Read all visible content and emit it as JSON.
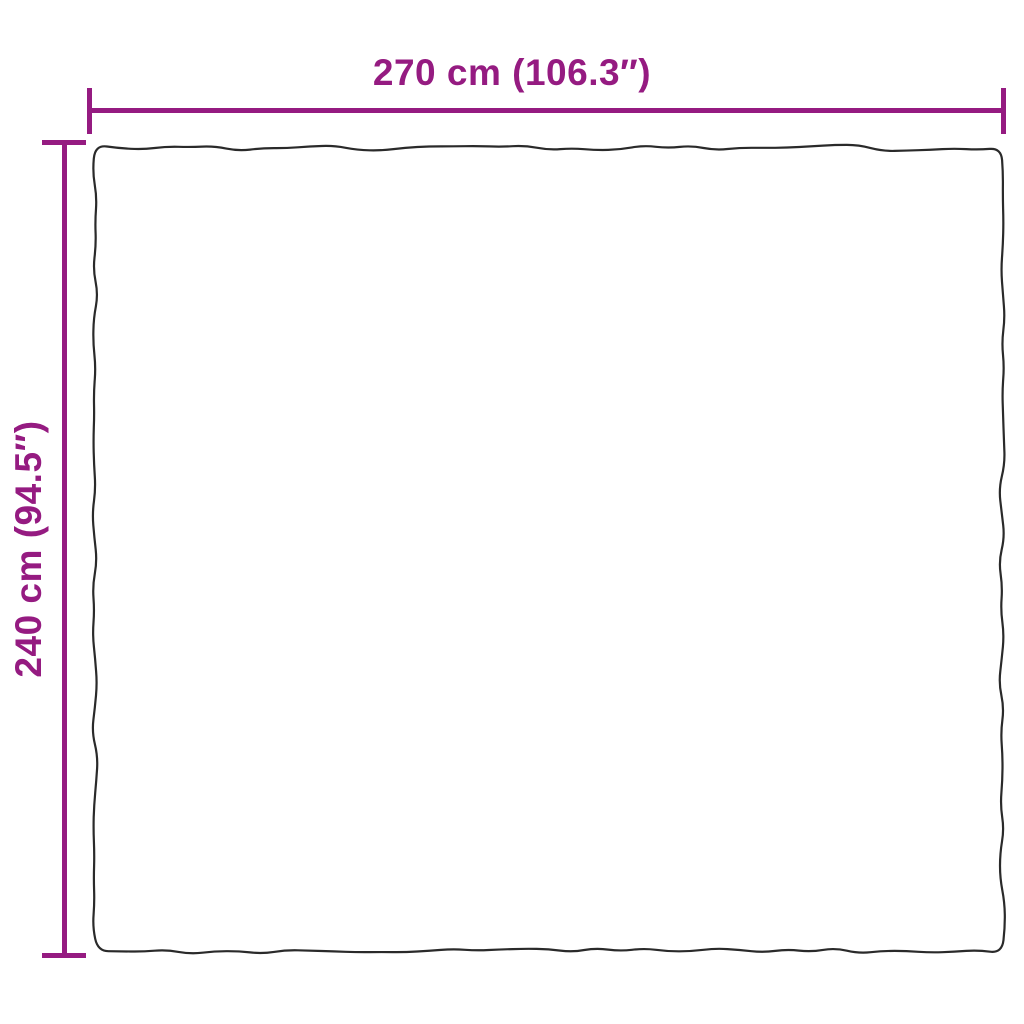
{
  "diagram": {
    "width_label": "270 cm (106.3″)",
    "height_label": "240 cm (94.5″)"
  },
  "colors": {
    "dimension": "#951b81",
    "outline": "#2a2a2a",
    "background": "#ffffff"
  }
}
